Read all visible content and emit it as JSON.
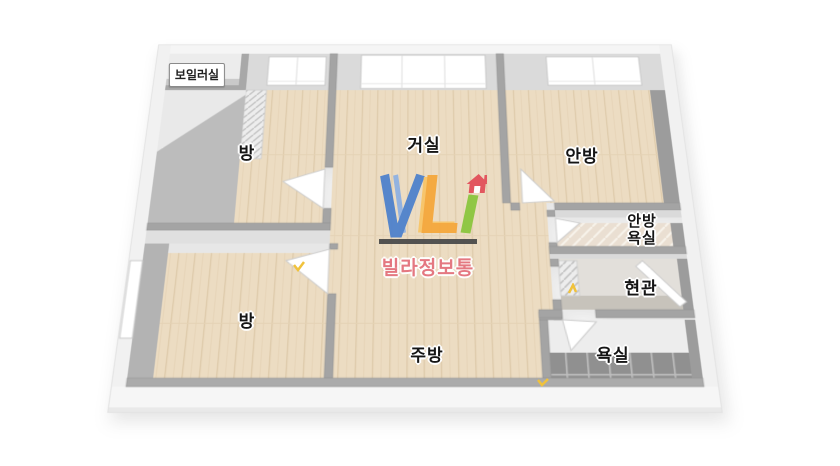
{
  "app": {
    "type": "3d-floor-plan-image",
    "description": "Axonometric 3D floor plan of an apartment with Korean room labels and watermark"
  },
  "watermark": {
    "letters": "VLI",
    "subtitle": "빌라정보통",
    "colors": {
      "v_blue": "#4f81cc",
      "v_blue_light": "#8fb0e2",
      "l_orange": "#f5a73b",
      "i_green": "#8cc63f",
      "house_red": "#e2505a",
      "underline_bar": "#4b4b4b",
      "subtitle_text": "#e4727e"
    }
  },
  "rooms": [
    {
      "id": "boiler-room",
      "label": "보일러실"
    },
    {
      "id": "bedroom-top-left",
      "label": "방"
    },
    {
      "id": "living-room",
      "label": "거실"
    },
    {
      "id": "master-bedroom",
      "label": "안방"
    },
    {
      "id": "master-bathroom",
      "label": "안방 욕실",
      "line1": "안방",
      "line2": "욕실"
    },
    {
      "id": "entrance",
      "label": "현관"
    },
    {
      "id": "bathroom",
      "label": "욕실"
    },
    {
      "id": "bedroom-bottom-left",
      "label": "방"
    },
    {
      "id": "kitchen",
      "label": "주방"
    }
  ],
  "door_markers": {
    "count": 3,
    "color": "#f0c23c"
  },
  "palette": {
    "background": "#ffffff",
    "floor_wood": "#ecdcc2",
    "wall_top_gray": "#a4a4a4",
    "wall_face_light": "#dcdcdc",
    "outer_wall_white": "#f4f4f4",
    "bathroom_tile_dark": "#909090",
    "label_text": "#151515"
  }
}
